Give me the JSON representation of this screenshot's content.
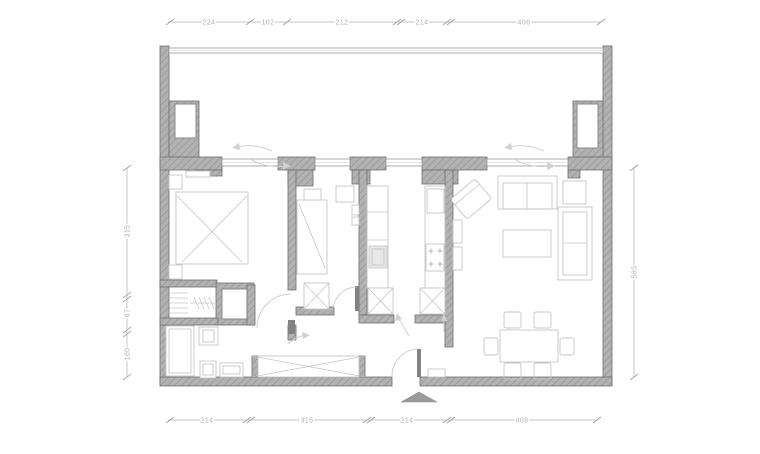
{
  "colors": {
    "wall": "#b2b2b2",
    "wallHatch": "#8f8f8f",
    "wallStroke": "#6f6f6f",
    "furniture": "#c6c6c6",
    "dimension": "#b2b2b2",
    "arrow": "#d0d0d0",
    "doorLeaf": "#828282",
    "entranceMarker": "#9a9a9a"
  },
  "dimensions": {
    "top": [
      "224",
      "102",
      "212",
      "214",
      "406"
    ],
    "bottom": [
      "214",
      "315",
      "214",
      "408"
    ],
    "left": [
      "315",
      "87",
      "160"
    ],
    "right": [
      "585"
    ]
  },
  "icons": {
    "entrance": "entrance-triangle-marker"
  }
}
